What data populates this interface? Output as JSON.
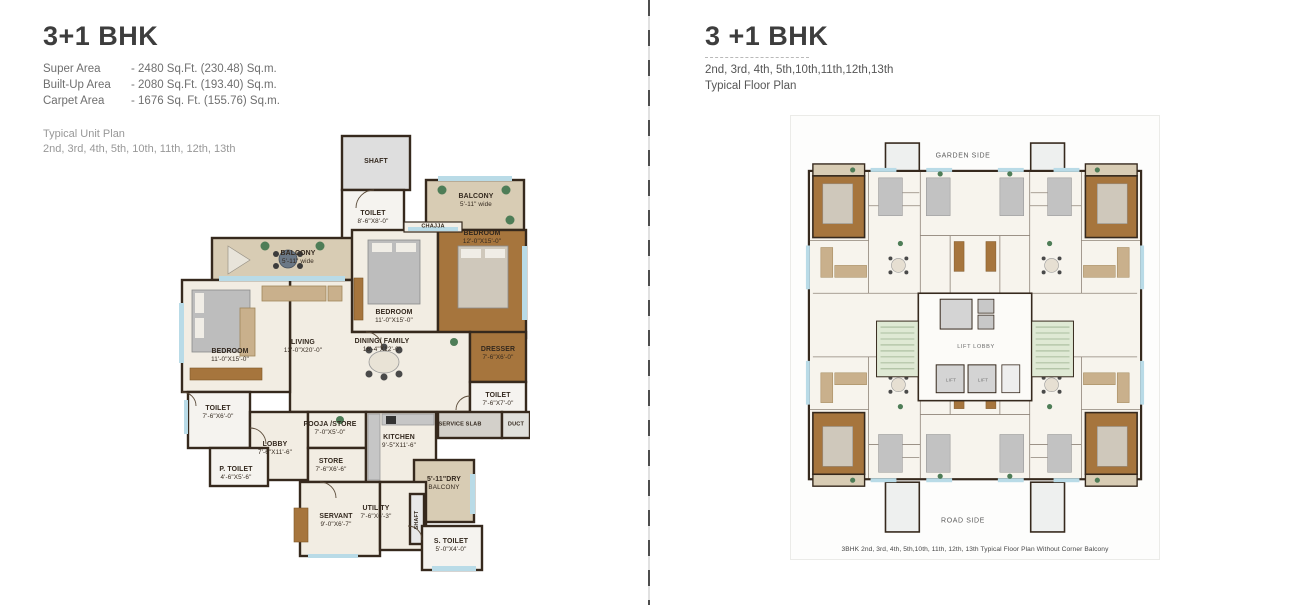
{
  "left": {
    "title": "3+1 BHK",
    "areas": [
      {
        "label": "Super Area",
        "value": "- 2480 Sq.Ft. (230.48) Sq.m."
      },
      {
        "label": "Built-Up Area",
        "value": "- 2080 Sq.Ft. (193.40) Sq.m."
      },
      {
        "label": "Carpet Area",
        "value": "- 1676 Sq. Ft. (155.76) Sq.m."
      }
    ],
    "note_line1": "Typical Unit Plan",
    "note_line2": "2nd, 3rd, 4th, 5th, 10th, 11th, 12th, 13th",
    "plan": {
      "rooms": {
        "shaft_top": {
          "name": "SHAFT"
        },
        "toilet_top": {
          "name": "TOILET",
          "dim": "8'-6\"X8'-0\""
        },
        "chajja": {
          "name": "CHAJJA"
        },
        "balcony_right": {
          "name": "BALCONY",
          "dim": "5'-11\" wide"
        },
        "bedroom_right": {
          "name": "BEDROOM",
          "dim": "12'-0\"X15'-0\""
        },
        "balcony_left": {
          "name": "BALCONY",
          "dim": "5'-11\" wide"
        },
        "bedroom_mid": {
          "name": "BEDROOM",
          "dim": "11'-0\"X15'-0\""
        },
        "living": {
          "name": "LIVING",
          "dim": "13'-0\"X20'-0\""
        },
        "dining": {
          "name": "DINING/ FAMILY",
          "dim": "16'-4\"X12'-0\""
        },
        "dresser": {
          "name": "DRESSER",
          "dim": "7'-6\"X6'-0\""
        },
        "toilet_right": {
          "name": "TOILET",
          "dim": "7'-6\"X7'-0\""
        },
        "duct": {
          "name": "DUCT"
        },
        "service_slab": {
          "name": "SERVICE SLAB"
        },
        "bedroom_left": {
          "name": "BEDROOM",
          "dim": "11'-0\"X15'-0\""
        },
        "toilet_left": {
          "name": "TOILET",
          "dim": "7'-6\"X6'-0\""
        },
        "lobby": {
          "name": "LOBBY",
          "dim": "7'-6\"X11'-6\""
        },
        "pooja": {
          "name": "POOJA /STORE",
          "dim": "7'-0\"X5'-0\""
        },
        "store": {
          "name": "STORE",
          "dim": "7'-6\"X6'-6\""
        },
        "kitchen": {
          "name": "KITCHEN",
          "dim": "9'-5\"X11'-6\""
        },
        "p_toilet": {
          "name": "P. TOILET",
          "dim": "4'-6\"X5'-6\""
        },
        "dry_balcony": {
          "name": "5'-11\"DRY",
          "dim": "BALCONY"
        },
        "servant": {
          "name": "SERVANT",
          "dim": "9'-0\"X6'-7\""
        },
        "utility": {
          "name": "UTILITY",
          "dim": "7'-6\"X6'-3\""
        },
        "shaft_small": {
          "name": "SHAFT"
        },
        "s_toilet": {
          "name": "S. TOILET",
          "dim": "5'-0\"X4'-0\""
        }
      }
    }
  },
  "right": {
    "title": "3 +1 BHK",
    "floors": "2nd, 3rd, 4th, 5th,10th,11th,12th,13th",
    "subtitle": "Typical Floor Plan",
    "plan": {
      "garden_side": "GARDEN SIDE",
      "road_side": "ROAD SIDE",
      "lift_lobby": "LIFT LOBBY",
      "lift1": "LIFT",
      "lift2": "LIFT",
      "caption": "3BHK 2nd, 3rd, 4th, 5th,10th, 11th, 12th, 13th Typical Floor Plan Without Corner Balcony"
    }
  },
  "colors": {
    "wall": "#36291d",
    "floor_cream": "#f2ede3",
    "tile": "#f5f3ef",
    "wood": "#a6753d",
    "balcony": "#d8ccb4",
    "window_glass": "#b9dbe7",
    "stair_green": "#dfe9d4",
    "lift_gray": "#d4d4d4",
    "plant_green": "#4e7d57"
  }
}
